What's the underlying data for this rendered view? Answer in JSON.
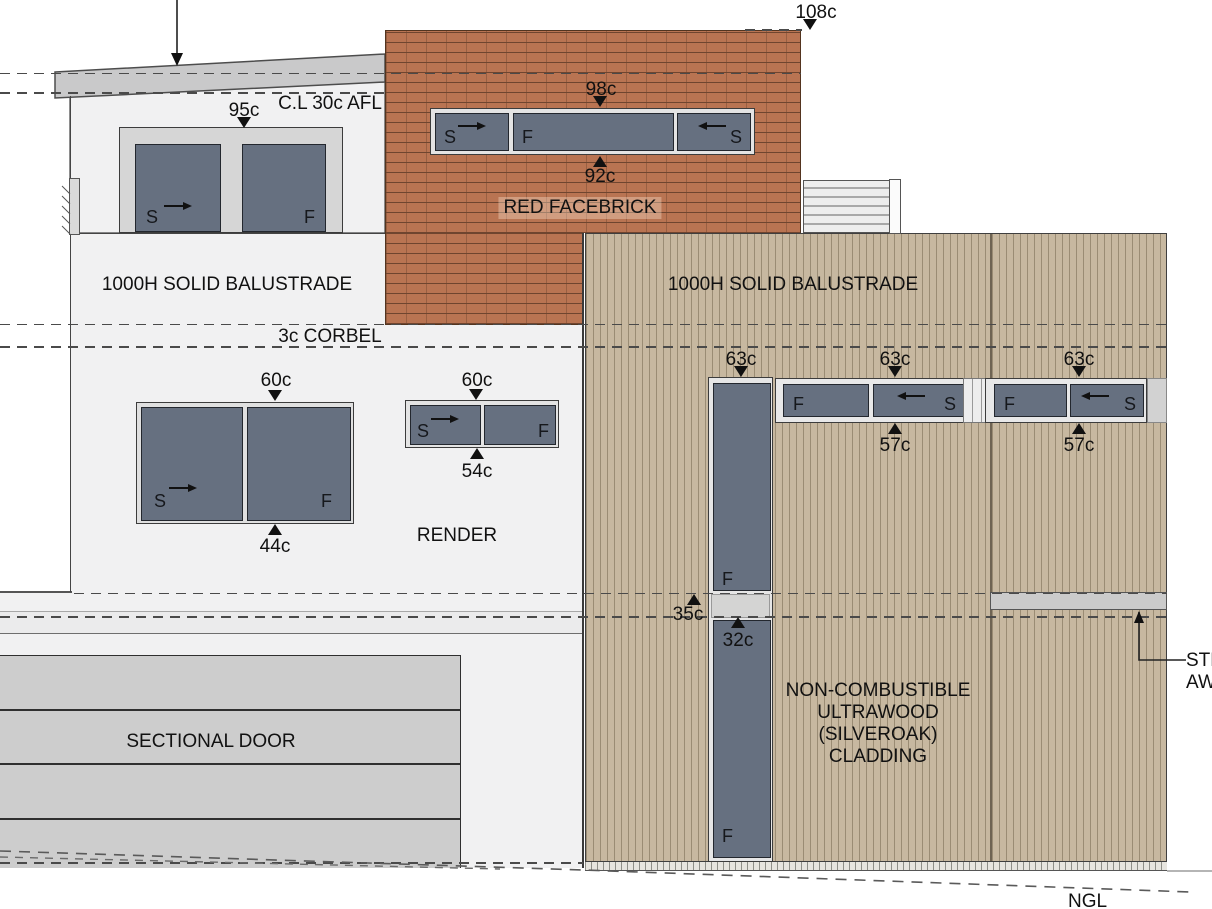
{
  "labels": {
    "cl_afl": "C.L 30c AFL",
    "balustrade": "1000H SOLID BALUSTRADE",
    "corbel": "3c CORBEL",
    "red_facebrick": "RED FACEBRICK",
    "render": "RENDER",
    "sectional_door": "SECTIONAL DOOR",
    "cladding_line1": "NON-COMBUSTIBLE",
    "cladding_line2": "ULTRAWOOD",
    "cladding_line3": "(SILVEROAK)",
    "cladding_line4": "CLADDING",
    "awning_line1": "STEEL",
    "awning_line2": "AWNING",
    "ngl": "NGL"
  },
  "dimensions": {
    "d108": "108c",
    "d95": "95c",
    "d98": "98c",
    "d92": "92c",
    "d60": "60c",
    "d44": "44c",
    "d54": "54c",
    "d63": "63c",
    "d57": "57c",
    "d35": "35c",
    "d32": "32c"
  },
  "glazing": {
    "S": "S",
    "F": "F"
  },
  "colors": {
    "brick": "#b97452",
    "cladding": "#c7b8a0",
    "glass": "#667080",
    "wall": "#f1f1f2",
    "garage_door": "#cdcdcd",
    "fascia": "#c9c9ca"
  }
}
